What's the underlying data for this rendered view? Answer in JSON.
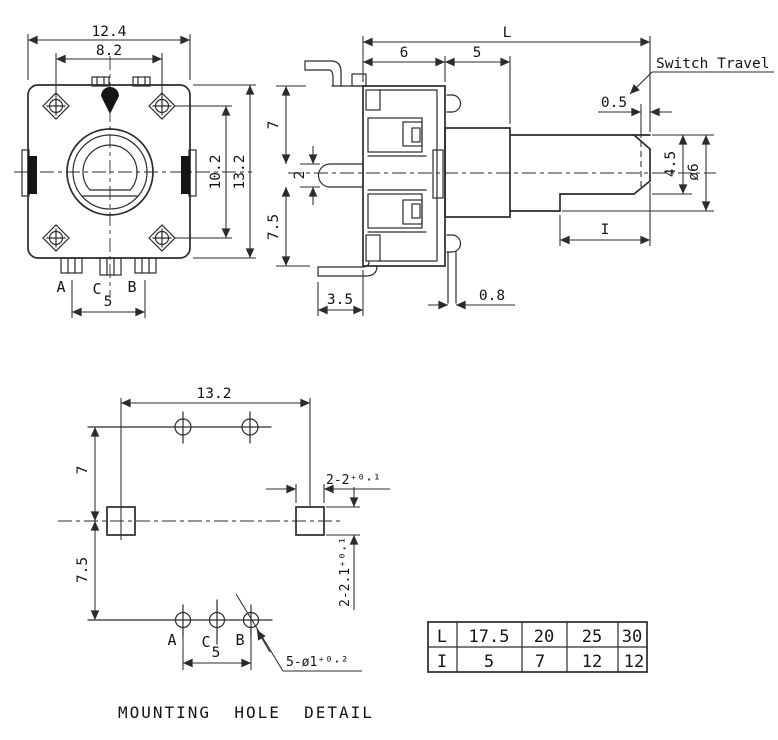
{
  "front_view": {
    "w_outer": "12.4",
    "w_inner": "8.2",
    "h_inner": "10.2",
    "h_outer": "13.2",
    "pin_a": "A",
    "pin_c": "C",
    "pin_b": "B",
    "pin_span": "5"
  },
  "side_view": {
    "length_label": "L",
    "body_depth": "6",
    "bushing_len": "5",
    "switch_travel": "Switch Travel",
    "travel": "0.5",
    "upper": "7",
    "lug": "2",
    "lower": "7.5",
    "pin_offset": "3.5",
    "bracket_gap": "0.8",
    "flat_height": "4.5",
    "shaft_dia": "ø6",
    "flat_len": "I"
  },
  "mounting_detail": {
    "width": "13.2",
    "upper": "7",
    "lower": "7.5",
    "slot_w": "2-2⁺⁰·¹",
    "slot_h": "2-2.1⁺⁰·¹",
    "pin_a": "A",
    "pin_c": "C",
    "pin_b": "B",
    "pin_span": "5",
    "holes_note": "5-ø1⁺⁰·²",
    "caption": "MOUNTING  HOLE  DETAIL"
  },
  "spec_table": {
    "rows": [
      {
        "label": "L",
        "values": [
          "17.5",
          "20",
          "25",
          "30"
        ]
      },
      {
        "label": "I",
        "values": [
          "5",
          "7",
          "12",
          "12"
        ]
      }
    ]
  },
  "colors": {
    "line": "#2b2b2b",
    "text": "#141414",
    "background": "#ffffff"
  }
}
